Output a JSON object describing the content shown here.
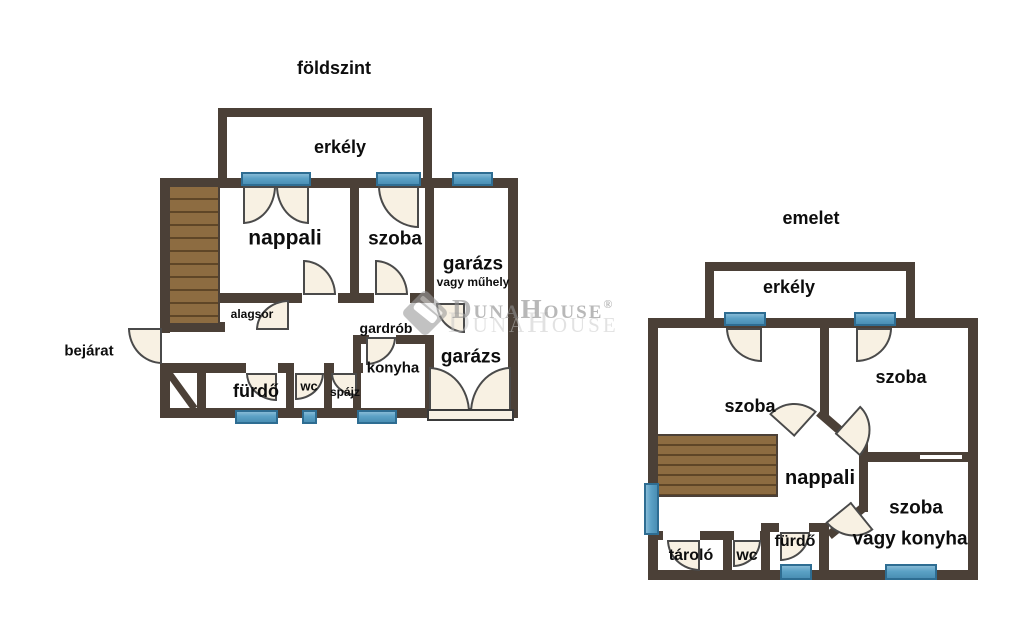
{
  "floor1": {
    "title": "földszint",
    "rooms": {
      "erkely": "erkély",
      "nappali": "nappali",
      "szoba": "szoba",
      "garazs_felso": "garázs",
      "garazs_felso_alt": "vagy műhely",
      "garazs_also": "garázs",
      "alagsor": "alagsor",
      "bejarat": "bejárat",
      "gardrob": "gardrób",
      "konyha": "konyha",
      "furdo": "fürdő",
      "wc": "wc",
      "spajz": "spájz"
    }
  },
  "floor2": {
    "title": "emelet",
    "rooms": {
      "erkely": "erkély",
      "szoba_bal": "szoba",
      "szoba_jobb": "szoba",
      "nappali": "nappali",
      "szoba_vagy_konyha_1": "szoba",
      "szoba_vagy_konyha_2": "vagy konyha",
      "tarolo": "tároló",
      "wc": "wc",
      "furdo": "fürdő"
    }
  },
  "watermark": {
    "brand": "DunaHouse",
    "registered": "®"
  },
  "colors": {
    "wall": "#4b4037",
    "window_fill": "#5ba1c5",
    "window_border": "#2e6d92",
    "door_fill": "#f8f1e3",
    "wood": "#8d6c41",
    "label_text": "#0d0d0d",
    "watermark_gray": "#8d8d8d",
    "background": "#ffffff"
  }
}
